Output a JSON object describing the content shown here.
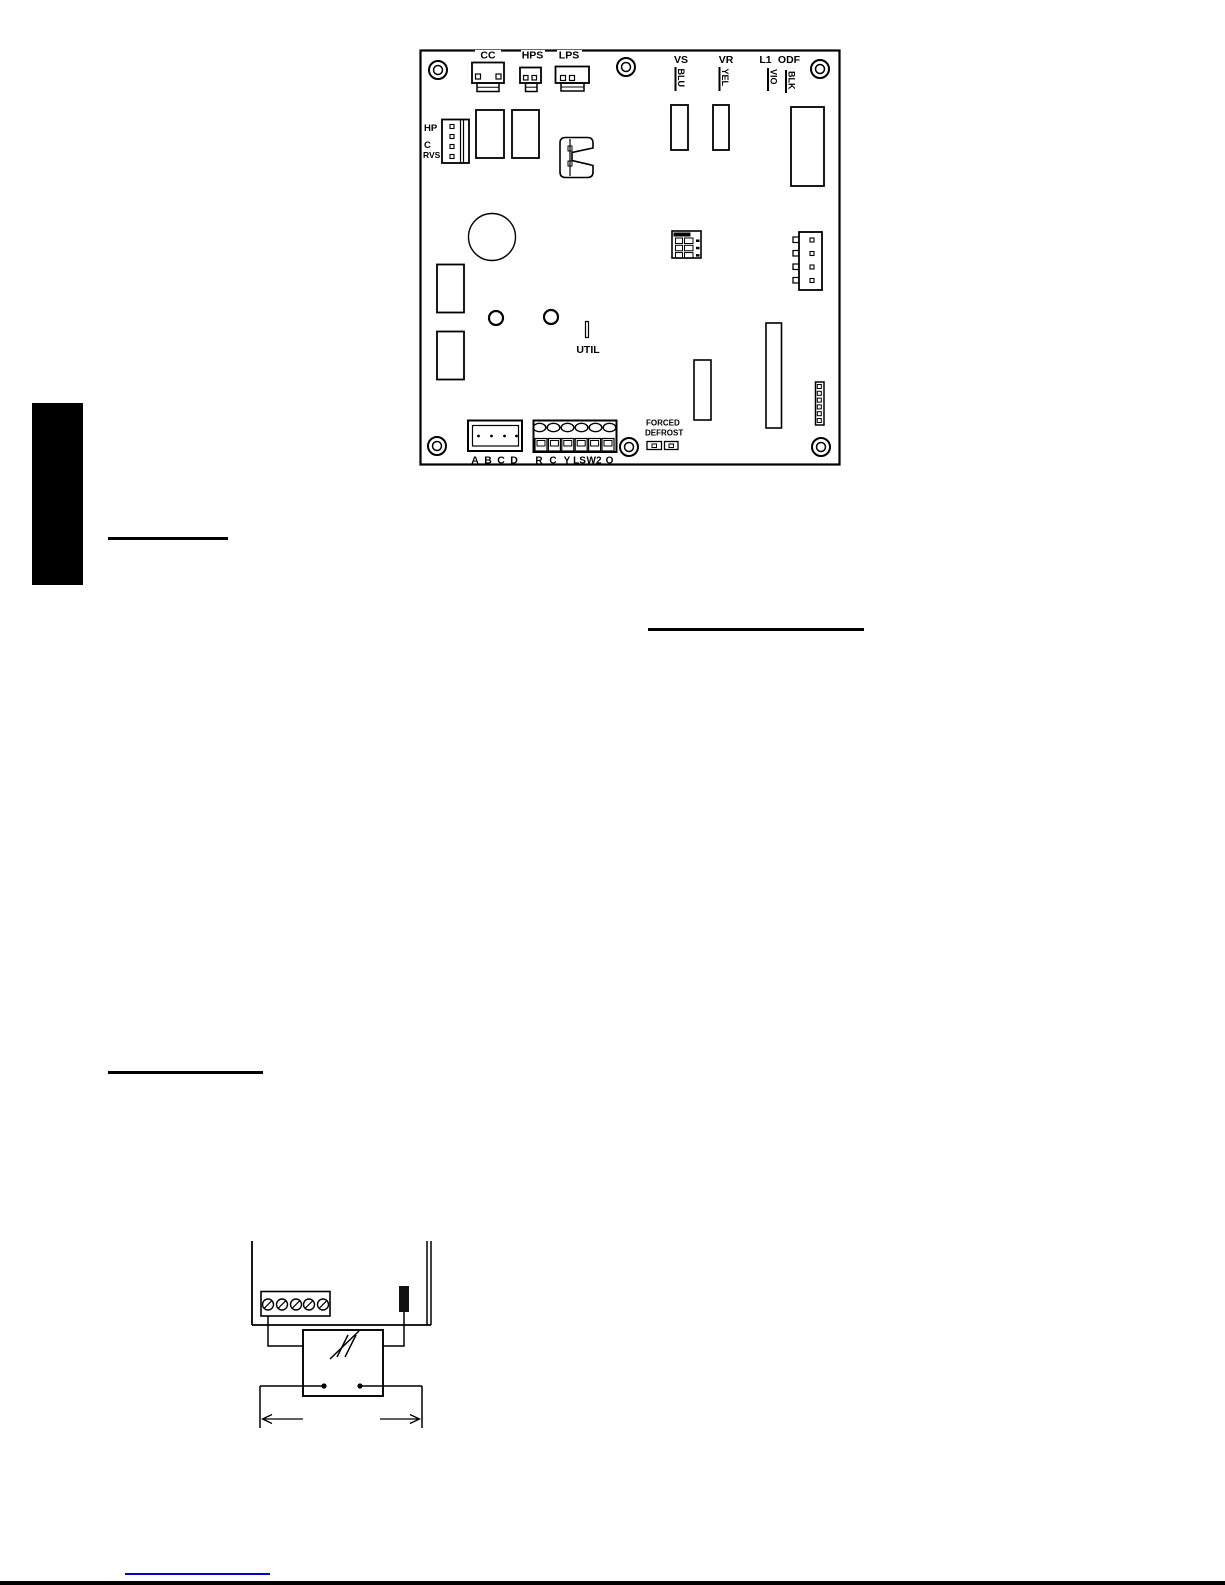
{
  "page": {
    "link_color": "#0000cc"
  },
  "board": {
    "top_connectors": [
      {
        "label": "CC"
      },
      {
        "label": "HPS"
      },
      {
        "label": "LPS"
      }
    ],
    "left_connector_labels": [
      "HP",
      "C",
      "RVS"
    ],
    "wire_terminals": [
      {
        "terminal": "VS",
        "wire_color": "BLU"
      },
      {
        "terminal": "VR",
        "wire_color": "YEL"
      },
      {
        "terminal": "L1",
        "wire_color": "VIO"
      },
      {
        "terminal": "ODF",
        "wire_color": "BLK"
      }
    ],
    "util_label": "UTIL",
    "forced_defrost_label": {
      "line1": "FORCED",
      "line2": "DEFROST"
    },
    "field_plug_labels": [
      "A",
      "B",
      "C",
      "D"
    ],
    "low_voltage_terminal_labels": [
      "R",
      "C",
      "Y",
      "LS",
      "W2",
      "O"
    ]
  }
}
